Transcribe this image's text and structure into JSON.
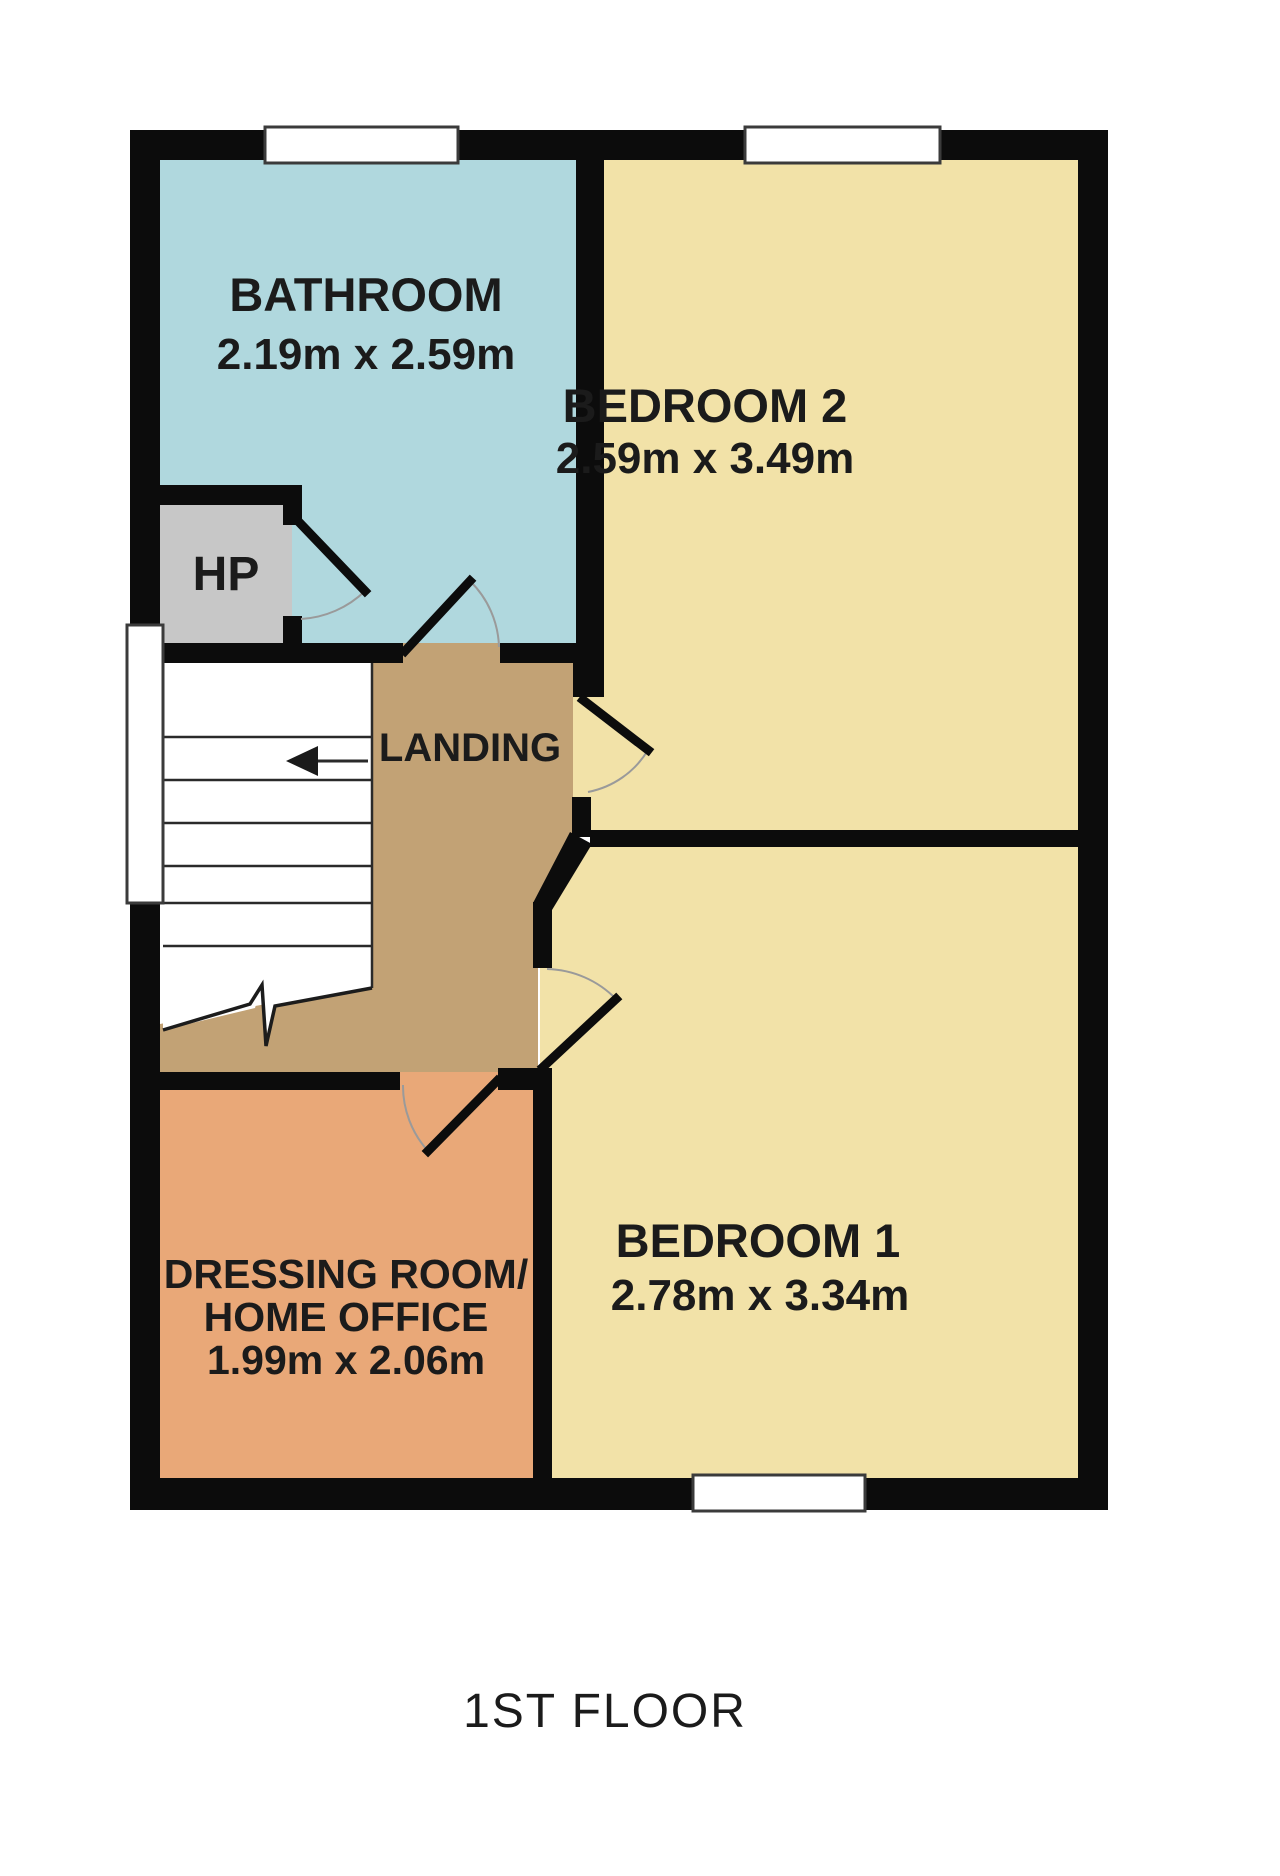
{
  "title": "1ST FLOOR",
  "rooms": {
    "bathroom": {
      "name": "BATHROOM",
      "dims": "2.19m x 2.59m"
    },
    "bedroom2": {
      "name": "BEDROOM 2",
      "dims": "2.59m x 3.49m"
    },
    "bedroom1": {
      "name": "BEDROOM 1",
      "dims": "2.78m x 3.34m"
    },
    "dressing": {
      "line1": "DRESSING ROOM/",
      "line2": "HOME OFFICE",
      "dims": "1.99m x 2.06m"
    },
    "landing": {
      "name": "LANDING"
    },
    "hot_press": {
      "name": "HP"
    }
  },
  "colors": {
    "bathroom": "#b0d8de",
    "bedroom": "#f2e2a8",
    "dressing": "#e9a878",
    "landing": "#c2a275",
    "hot_press": "#c7c7c7",
    "wall": "#0c0c0c",
    "floor_label": "#6d6d6d"
  }
}
